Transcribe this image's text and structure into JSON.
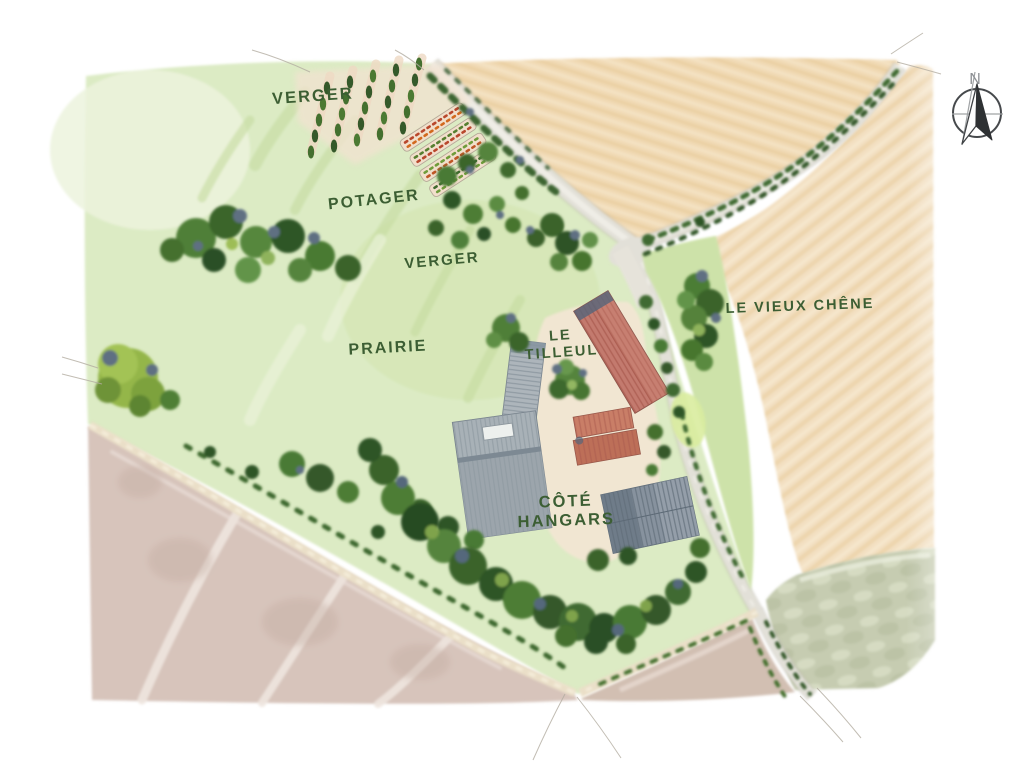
{
  "map": {
    "labels": [
      {
        "id": "verger-north",
        "text": "VERGER"
      },
      {
        "id": "potager",
        "text": "POTAGER"
      },
      {
        "id": "verger-south",
        "text": "VERGER"
      },
      {
        "id": "prairie",
        "text": "PRAIRIE"
      },
      {
        "id": "le-tilleul",
        "text": "LE\nTILLEUL"
      },
      {
        "id": "le-vieux-chene",
        "text": "LE VIEUX CHÊNE"
      },
      {
        "id": "cote-hangars",
        "text": "CÔTÉ\nHANGARS"
      }
    ],
    "compass": {
      "letter": "N"
    },
    "palette": {
      "label_ink": "#3c5e33",
      "meadow_green": "#dcebc4",
      "wheat_field": "#f1dab5",
      "plowed_field": "#d7c4bb",
      "sage_field": "#c6ccb1",
      "road_gray": "#e2e0d8",
      "tree_green": "#4a7a35",
      "tree_shadow_slate": "#5e7082",
      "barn_red": "#c37a6e",
      "roof_gray": "#a8b1b7",
      "hangar_dark_gray": "#87929e",
      "courtyard_cream": "#f1e6d2",
      "compass_ink": "#46494c"
    }
  }
}
